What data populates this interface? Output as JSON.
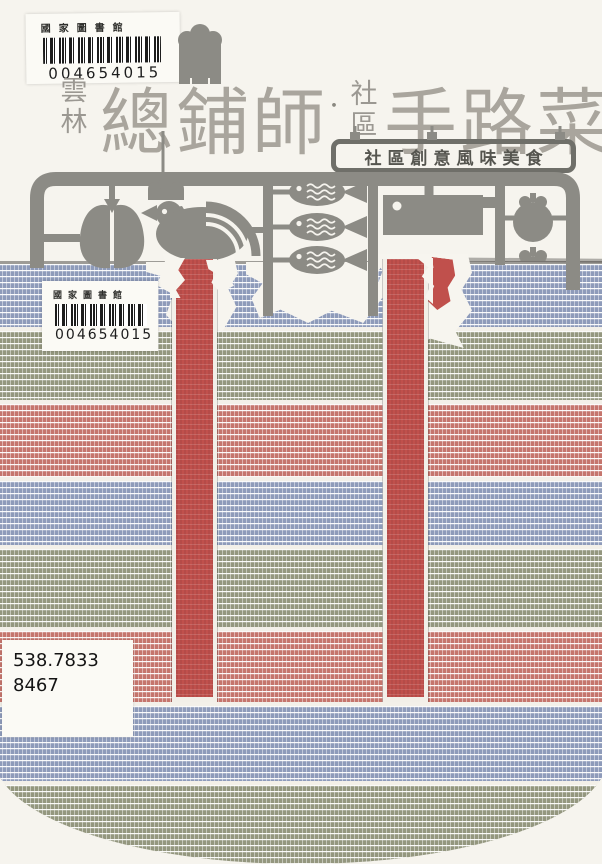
{
  "labels": {
    "library_top": {
      "institution": "國家圖書館",
      "barcode_number": "004654015"
    },
    "library_bag": {
      "institution": "國家圖書館",
      "barcode_number": "004654015"
    },
    "call_number": {
      "line1": "538.7833",
      "line2": "8467"
    }
  },
  "title": {
    "prefix_chars": [
      "雲",
      "林"
    ],
    "main_first": "總鋪師",
    "separator": "・",
    "mid_chars": [
      "社",
      "區"
    ],
    "main_second": "手路菜",
    "subtitle_banner": "社區創意風味美食"
  },
  "icons": [
    "chef-hat-icon",
    "pork-icon",
    "rooster-icon",
    "fish-icon",
    "fish-icon",
    "fish-icon",
    "cleaver-icon",
    "tomato-icon",
    "tomato-icon",
    "wok-handle-icon",
    "wok-handle-icon"
  ],
  "colors": {
    "background": "#f6f4ee",
    "sprue_gray": "#8c8b85",
    "title_gray": "#a9a59d",
    "banner_gray": "#6f6f69",
    "stripe_blue": "#8e9bba",
    "stripe_green": "#94977f",
    "stripe_red": "#c5756d",
    "strap_red": "#c0504c",
    "handle_gray": "#6f6f69",
    "label_white": "#fbfaf5",
    "barcode_black": "#1c1c1c"
  },
  "bag": {
    "stripes": [
      {
        "name": "blue",
        "hex": "#8e9bba",
        "height": 63
      },
      {
        "name": "green",
        "hex": "#94977f",
        "height": 69
      },
      {
        "name": "red",
        "hex": "#c5756d",
        "height": 73
      },
      {
        "name": "blue",
        "hex": "#8e9bba",
        "height": 64
      },
      {
        "name": "green",
        "hex": "#94977f",
        "height": 78
      },
      {
        "name": "red",
        "hex": "#c5756d",
        "height": 71
      },
      {
        "name": "blue",
        "hex": "#8e9bba",
        "height": 75
      },
      {
        "name": "green",
        "hex": "#94977f",
        "height": 95
      }
    ]
  }
}
